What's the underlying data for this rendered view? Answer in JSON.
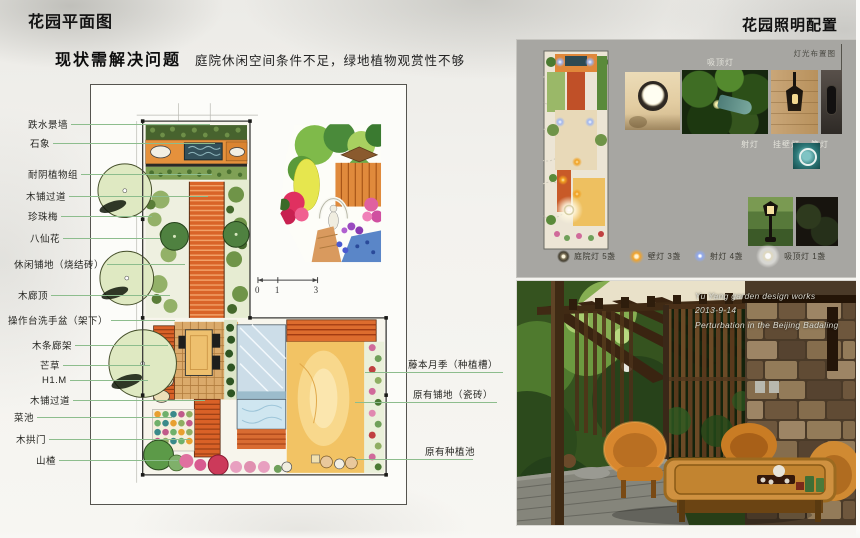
{
  "page": {
    "title_left": "花园平面图",
    "title_right": "花园照明配置",
    "problem_heading": "现状需解决问题",
    "problem_text": "庭院休闲空间条件不足，绿地植物观赏性不够"
  },
  "plan": {
    "labels_left": [
      "跌水景墙",
      "石象",
      "耐阴植物组",
      "木铺过道",
      "珍珠梅",
      "八仙花",
      "休闲铺地（烧结砖）",
      "木廊顶",
      "操作台洗手盆（架下）",
      "木条廊架",
      "芒草",
      "H1.M",
      "木铺过道",
      "菜池",
      "木拱门",
      "山楂"
    ],
    "labels_right": [
      "藤本月季（种植槽）",
      "原有铺地（瓷砖）",
      "原有种植池"
    ],
    "scale_ticks": [
      "0",
      "1",
      "3"
    ]
  },
  "lighting": {
    "corner_label": "灯光布置图",
    "top_label": "吸顶灯",
    "photo_labels": [
      "射灯",
      "挂壁灯",
      "筒灯"
    ],
    "legend": [
      {
        "name": "庭院灯",
        "count": "5盏",
        "color": "#efe6c8"
      },
      {
        "name": "壁灯",
        "count": "3盏",
        "color": "#f2a32a"
      },
      {
        "name": "射灯",
        "count": "4盏",
        "color": "#8fa8ee"
      },
      {
        "name": "吸顶灯",
        "count": "1盏",
        "color": "#ffffff"
      }
    ]
  },
  "photo": {
    "caption": [
      "Yu Yang garden design works",
      "2013-9-14",
      "Perturbation in the Beijing Badaling"
    ]
  }
}
